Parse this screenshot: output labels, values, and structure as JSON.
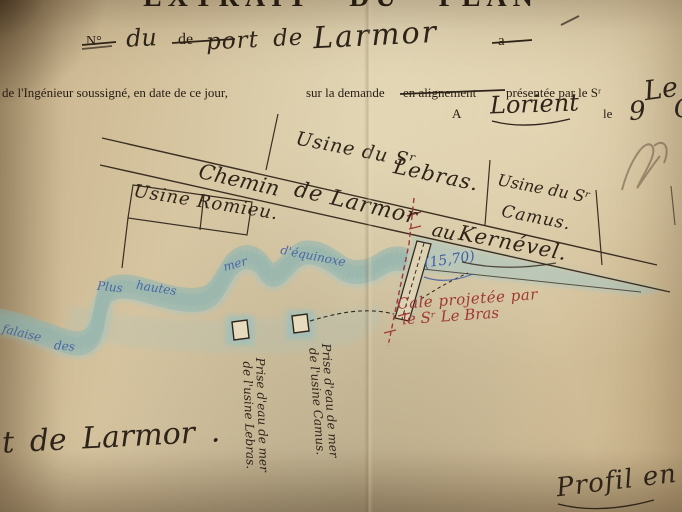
{
  "header": {
    "title": "EXTRAIT DU PLAN",
    "line_no": {
      "no": "N°",
      "du": "du",
      "de": "de",
      "port_de": "port de",
      "larmor": "Larmor",
      "a": "a"
    },
    "printed": {
      "seg1": "de l'Ingénieur soussigné, en date de ce jour,",
      "seg2": "sur la demande",
      "struck": "en alignement",
      "seg3": "présentée par le Sʳ",
      "name_flourish": "Le"
    },
    "dateline": {
      "a": "A",
      "city": "Lorient",
      "le": "le",
      "date": "9 O"
    }
  },
  "map": {
    "road": {
      "w1": "Chemin",
      "w2": "de Larmor",
      "w3": "au",
      "w4": "Kernével."
    },
    "labels": {
      "romieu": "Usine Romieu.",
      "lebras1": "Usine du Sʳ",
      "lebras2": "Lebras.",
      "camus1": "Usine du Sʳ",
      "camus2": "Camus."
    },
    "cale": {
      "l1": "Cale projetée par",
      "l2": "le Sʳ Le Bras",
      "measure": "(15,70)"
    },
    "intakes": {
      "lebras1": "Prise d'eau de mer",
      "lebras2": "de l'usine Lebras.",
      "camus1": "Prise d'eau de mer",
      "camus2": "de l'usine Camus."
    },
    "coast": {
      "n1": "Plus",
      "n2": "hautes",
      "n3": "mer",
      "n4": "d'équinoxe",
      "n5": "falaise",
      "n6": "des"
    },
    "port": "t de Larmor .",
    "profil": "Profil en"
  },
  "colors": {
    "ink": "#2e241a",
    "red_ink": "#a03832",
    "blue_ink": "#3f5fa4",
    "sea_wash": "#9fc6c9",
    "paper": "#d6c5a0"
  }
}
